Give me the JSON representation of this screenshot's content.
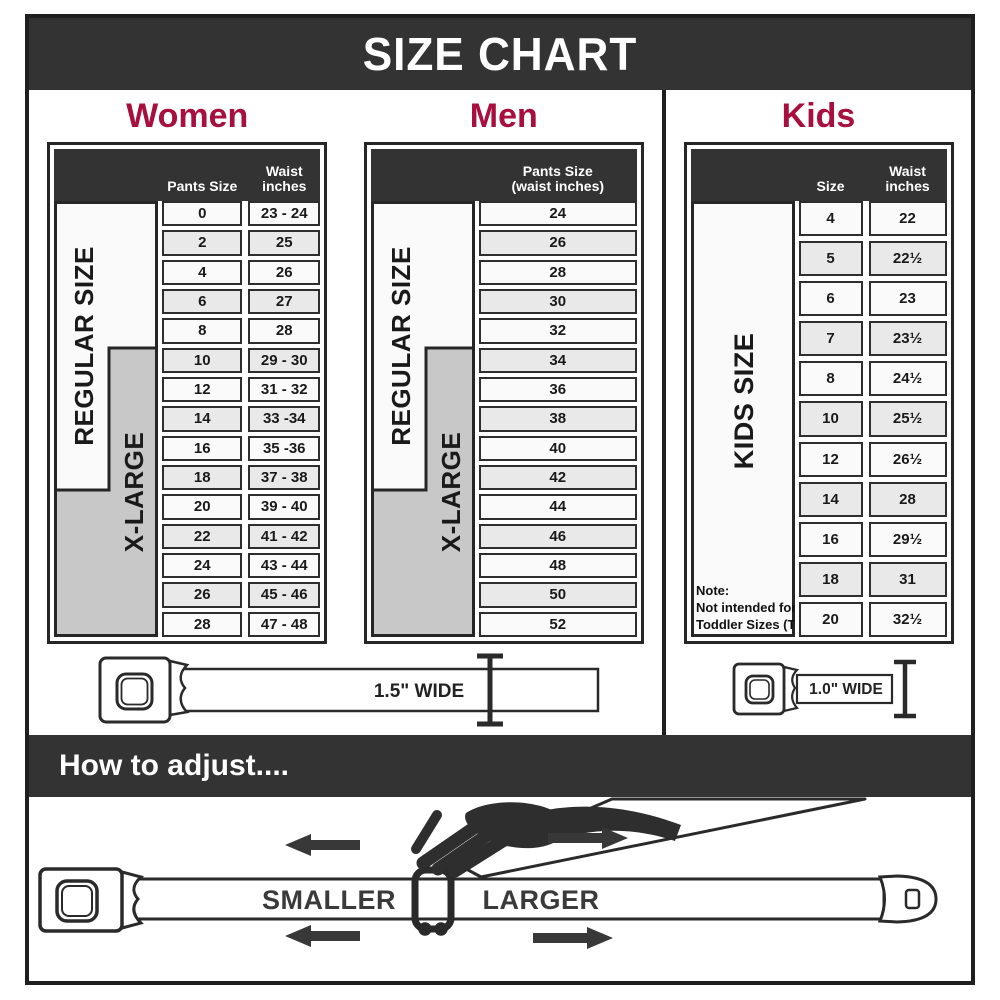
{
  "title": "SIZE CHART",
  "colors": {
    "accent": "#a60f3e",
    "dark_band": "#333333",
    "xlarge_gray": "#c8c8c8",
    "row_light": "#fafafa",
    "row_gray": "#e9e9e9"
  },
  "women": {
    "heading": "Women",
    "header": {
      "col1": "Pants Size",
      "col2_line1": "Waist",
      "col2_line2": "inches"
    },
    "regular_label": "REGULAR SIZE",
    "xlarge_label": "X-LARGE",
    "rows": [
      {
        "size": "0",
        "waist": "23 - 24"
      },
      {
        "size": "2",
        "waist": "25"
      },
      {
        "size": "4",
        "waist": "26"
      },
      {
        "size": "6",
        "waist": "27"
      },
      {
        "size": "8",
        "waist": "28"
      },
      {
        "size": "10",
        "waist": "29 - 30"
      },
      {
        "size": "12",
        "waist": "31 - 32"
      },
      {
        "size": "14",
        "waist": "33 -34"
      },
      {
        "size": "16",
        "waist": "35 -36"
      },
      {
        "size": "18",
        "waist": "37 - 38"
      },
      {
        "size": "20",
        "waist": "39 - 40"
      },
      {
        "size": "22",
        "waist": "41 - 42"
      },
      {
        "size": "24",
        "waist": "43 - 44"
      },
      {
        "size": "26",
        "waist": "45 - 46"
      },
      {
        "size": "28",
        "waist": "47 - 48"
      }
    ]
  },
  "men": {
    "heading": "Men",
    "header": {
      "line1": "Pants Size",
      "line2": "(waist inches)"
    },
    "regular_label": "REGULAR SIZE",
    "xlarge_label": "X-LARGE",
    "rows": [
      "24",
      "26",
      "28",
      "30",
      "32",
      "34",
      "36",
      "38",
      "40",
      "42",
      "44",
      "46",
      "48",
      "50",
      "52"
    ]
  },
  "kids": {
    "heading": "Kids",
    "header": {
      "col1": "Size",
      "col2_line1": "Waist",
      "col2_line2": "inches"
    },
    "stub_label": "KIDS SIZE",
    "note": [
      "Note:",
      "Not intended for",
      "Toddler Sizes (T)"
    ],
    "rows": [
      {
        "size": "4",
        "waist": "22"
      },
      {
        "size": "5",
        "waist": "22½"
      },
      {
        "size": "6",
        "waist": "23"
      },
      {
        "size": "7",
        "waist": "23½"
      },
      {
        "size": "8",
        "waist": "24½"
      },
      {
        "size": "10",
        "waist": "25½"
      },
      {
        "size": "12",
        "waist": "26½"
      },
      {
        "size": "14",
        "waist": "28"
      },
      {
        "size": "16",
        "waist": "29½"
      },
      {
        "size": "18",
        "waist": "31"
      },
      {
        "size": "20",
        "waist": "32½"
      }
    ]
  },
  "belts": {
    "adult_width_label": "1.5\" WIDE",
    "kids_width_label": "1.0\" WIDE"
  },
  "how_to": {
    "heading": "How to adjust....",
    "smaller_label": "SMALLER",
    "larger_label": "LARGER"
  }
}
